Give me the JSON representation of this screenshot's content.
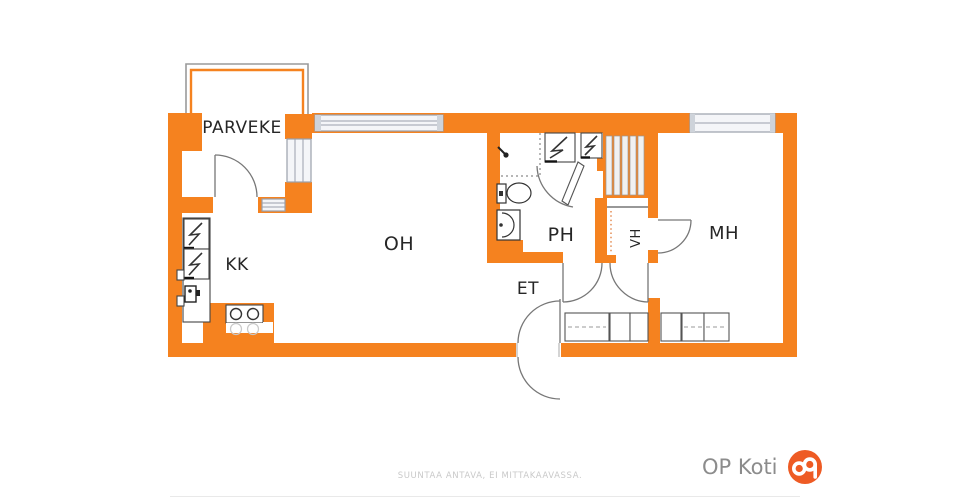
{
  "floorplan": {
    "rooms": [
      {
        "id": "parveke",
        "label": "PARVEKE"
      },
      {
        "id": "kk",
        "label": "KK"
      },
      {
        "id": "oh",
        "label": "OH"
      },
      {
        "id": "ph",
        "label": "PH"
      },
      {
        "id": "et",
        "label": "ET"
      },
      {
        "id": "vh",
        "label": "VH"
      },
      {
        "id": "mh",
        "label": "MH"
      }
    ],
    "fixtures": [
      "refrigerator-icon",
      "freezer-icon",
      "kitchen-sink-icon",
      "stove-icon",
      "shower-icon",
      "toilet-icon",
      "washbasin-icon",
      "washing-machine-icon",
      "dryer-icon",
      "closet-shelves-icon",
      "wardrobe-icon",
      "door-arc-icon",
      "window-icon",
      "balcony-railing-icon"
    ],
    "colors": {
      "wall": "#F5821F",
      "logo": "#EE5B24",
      "label": "#262626",
      "disclaimer": "#C9C9C9",
      "brand_text": "#8C8C8C"
    }
  },
  "footer": {
    "disclaimer": "SUUNTAA ANTAVA, EI MITTAKAAVASSA.",
    "brand": "OP Koti"
  }
}
